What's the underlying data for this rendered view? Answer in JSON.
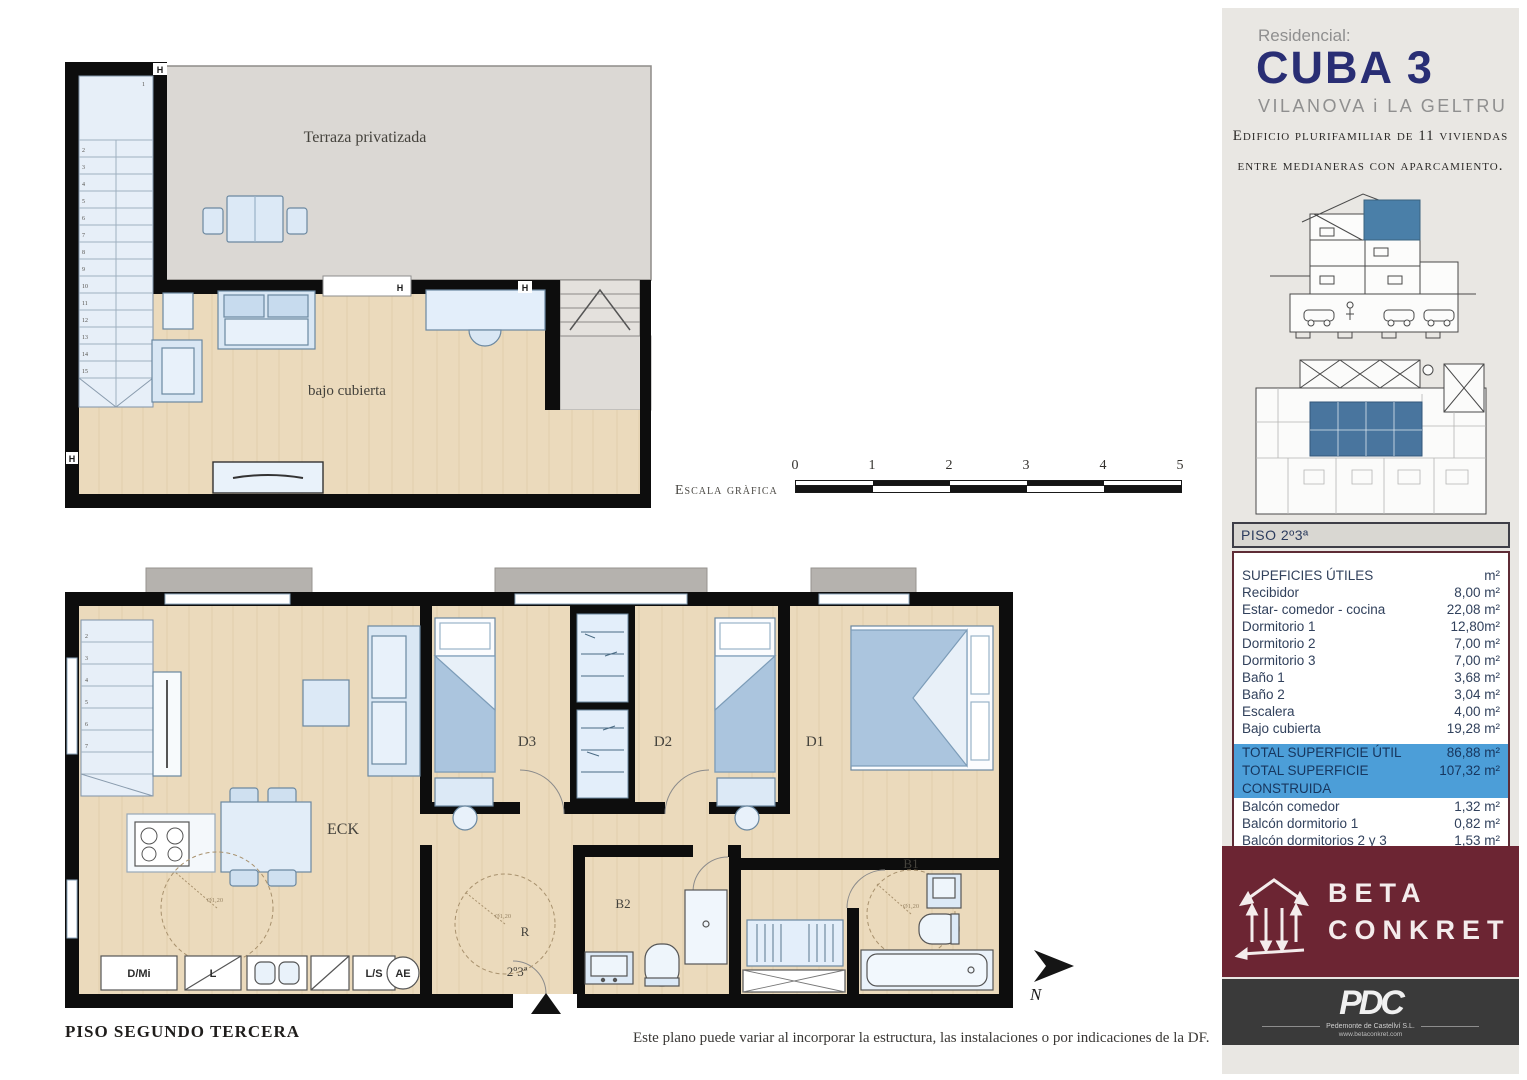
{
  "sidebar": {
    "residential_label": "Residencial:",
    "project_name": "CUBA 3",
    "city": "VILANOVA i LA GELTRU",
    "description_line1": "Edificio plurifamiliar de 11 viviendas",
    "description_line2": "entre medianeras con aparcamiento.",
    "table": {
      "header": "PISO  2º3ª",
      "rows": [
        {
          "label": "SUPEFICIES ÚTILES",
          "value": "m²"
        },
        {
          "label": "Recibidor",
          "value": "8,00 m²"
        },
        {
          "label": "Estar- comedor - cocina",
          "value": "22,08 m²"
        },
        {
          "label": "Dormitorio 1",
          "value": "12,80m²"
        },
        {
          "label": "Dormitorio 2",
          "value": "7,00 m²"
        },
        {
          "label": "Dormitorio 3",
          "value": "7,00 m²"
        },
        {
          "label": "Baño 1",
          "value": "3,68 m²"
        },
        {
          "label": "Baño 2",
          "value": "3,04 m²"
        },
        {
          "label": "Escalera",
          "value": "4,00 m²"
        },
        {
          "label": "Bajo cubierta",
          "value": "19,28 m²"
        }
      ],
      "totals": [
        {
          "label": "TOTAL SUPERFICIE ÚTIL",
          "value": "86,88 m²"
        },
        {
          "label": "TOTAL SUPERFICIE CONSTRUIDA",
          "value": "107,32 m²"
        }
      ],
      "extras": [
        {
          "label": "Balcón comedor",
          "value": "1,32 m²"
        },
        {
          "label": "Balcón dormitorio 1",
          "value": "0,82 m²"
        },
        {
          "label": "Balcón dormitorios 2 y 3",
          "value": "1,53 m²"
        },
        {
          "label": "Terraza privatizada",
          "value": "25,30 m²"
        }
      ]
    },
    "beta_conkret": {
      "line1": "BETA",
      "line2": "CONKRET"
    },
    "pdc": {
      "logo": "PDC",
      "subtitle": "Pedemonte de Castellví S.L.",
      "url": "www.betaconkret.com"
    }
  },
  "plans": {
    "upper": {
      "terrace_label": "Terraza privatizada",
      "room_label": "bajo cubierta",
      "hinge_label": "H",
      "stair_numbers": [
        "1",
        "2",
        "3",
        "4",
        "5",
        "6",
        "7",
        "8",
        "9",
        "10",
        "11",
        "12",
        "13",
        "14",
        "15"
      ]
    },
    "lower": {
      "living_label": "ECK",
      "bedroom1_label": "D1",
      "bedroom2_label": "D2",
      "bedroom3_label": "D3",
      "bath1_label": "B1",
      "bath2_label": "B2",
      "hall_label": "R",
      "unit_label": "2º3ª",
      "appliance_labels": [
        "D/Mi",
        "L",
        "L/S",
        "AE"
      ],
      "diameter_label": "Ø1,20",
      "stair_numbers": [
        "2",
        "3",
        "4",
        "5",
        "6",
        "7"
      ]
    }
  },
  "scale_bar": {
    "label": "Escala gràfica",
    "ticks": [
      "0",
      "1",
      "2",
      "3",
      "4",
      "5"
    ]
  },
  "compass": {
    "north_label": "N"
  },
  "footer": {
    "plan_title": "PISO SEGUNDO TERCERA",
    "disclaimer": "Este plano puede variar al incorporar la estructura, las instalaciones o por indicaciones de la DF."
  },
  "colors": {
    "accent_blue": "#4C9ED8",
    "brand_navy": "#292E74",
    "beta_maroon": "#6C2533",
    "pdc_gray": "#3A3A3A",
    "unit_highlight": "#4A7FA8",
    "wall_black": "#0D0D0D",
    "floor_wood": "#EBDABC",
    "terrace_gray": "#DBD8D4"
  }
}
